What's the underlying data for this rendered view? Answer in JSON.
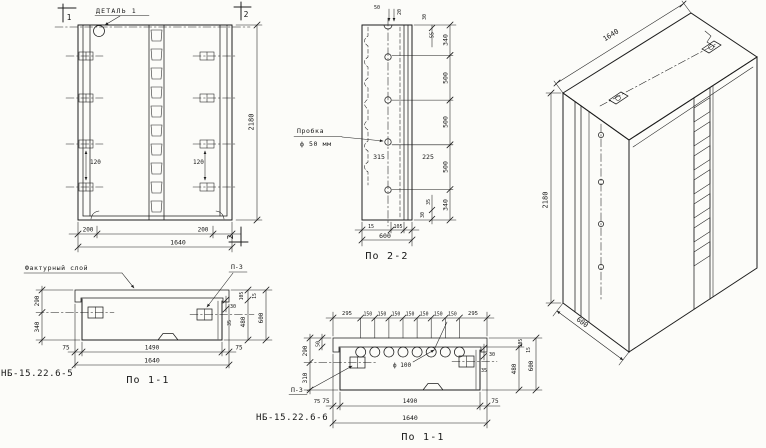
{
  "front_view": {
    "detail_label": "ДЕТАЛЬ 1",
    "cut1_top": "1",
    "cut2_top": "2",
    "cut2_bottom": "2",
    "dim_120_left": "120",
    "dim_120_right": "120",
    "dim_200_left": "200",
    "dim_200_right": "200",
    "dim_width": "1640",
    "dim_height": "2180"
  },
  "section_2_2": {
    "title": "По 2-2",
    "plug_label_line1": "Пробка",
    "plug_label_line2": "ф 50 мм",
    "dim_315": "315",
    "dim_225": "225",
    "dim_top_50": "50",
    "dim_top_20": "20",
    "dim_top_30": "30",
    "dim_top_55": "55",
    "chain": [
      "340",
      "500",
      "500",
      "500",
      "340"
    ],
    "dim_bot_35": "35",
    "dim_bot_30": "30",
    "dim_bot_15": "15",
    "dim_bot_105": "105",
    "dim_width": "600"
  },
  "iso_view": {
    "dim_width": "1640",
    "dim_height": "2180",
    "dim_depth": "600"
  },
  "plan_view_a": {
    "mark": "НБ-15.22.6-5",
    "title": "По 1-1",
    "factured_layer_label": "Фактурный слой",
    "plate_label": "П-3",
    "dim_290": "290",
    "dim_340": "340",
    "dim_30": "30",
    "dim_35": "35",
    "dim_105": "105",
    "dim_15": "15",
    "dim_480": "480",
    "dim_600": "600",
    "dim_75_left": "75",
    "dim_1490": "1490",
    "dim_75_right": "75",
    "dim_width": "1640"
  },
  "plan_view_b": {
    "mark": "НБ-15.22.6-6",
    "title": "По 1-1",
    "plate_label": "П-3",
    "hole_label": "ф 100",
    "dim_295_left": "295",
    "dim_150": "150",
    "dim_295_right": "295",
    "dim_50": "50",
    "dim_290": "290",
    "dim_310": "310",
    "dim_30": "30",
    "dim_35": "35",
    "dim_105": "105",
    "dim_15": "15",
    "dim_480": "480",
    "dim_600": "600",
    "dim_75_plate": "75",
    "dim_75_left": "75",
    "dim_1490": "1490",
    "dim_75_right": "75",
    "dim_width": "1640"
  }
}
